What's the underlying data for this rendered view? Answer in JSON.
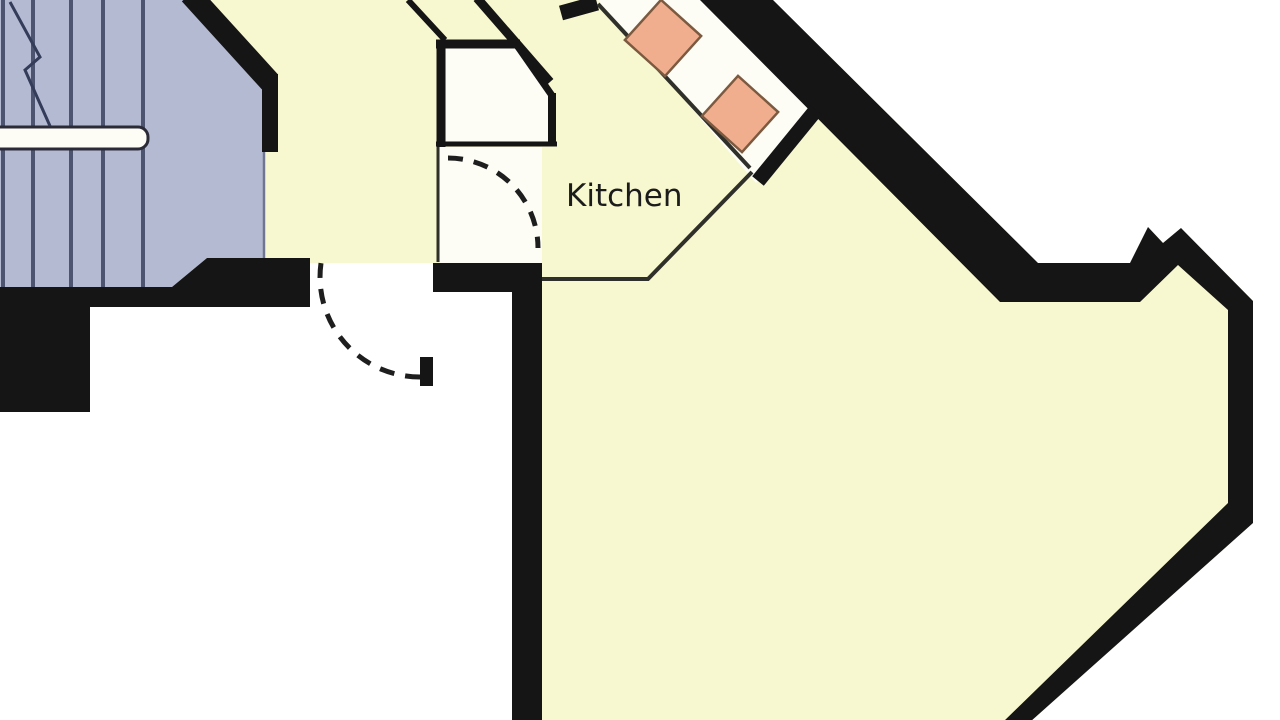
{
  "title": "Apartment floor plan",
  "labels": {
    "kitchen": "Kitchen"
  },
  "rooms": [
    "stairwell",
    "hallway",
    "closet",
    "vestibule",
    "kitchen",
    "living-area",
    "unfinished-room"
  ],
  "palette": {
    "paper": "#ffffff",
    "white": "#fdfdf6",
    "cream": "#f8f8d0",
    "blue": "#b5bad3",
    "tread": "#4c5470",
    "zigzag": "#333c58",
    "railStroke": "#2b2b38",
    "wall": "#151515",
    "thin": "#30302a",
    "arc": "#1e1e1e",
    "orange": "#f1ae8e",
    "orangeBorder": "#7b5a40",
    "text": "#1c1c1c",
    "edge": "#707690"
  },
  "floorplan": {
    "width": 1280,
    "height": 720,
    "elements": [
      {
        "name": "canvas-background",
        "type": "rect",
        "x": 0,
        "y": 0,
        "w": 1280,
        "h": 720,
        "fill": "paper"
      },
      {
        "name": "apartment-floor",
        "type": "polygon",
        "fill": "cream",
        "points": [
          [
            0,
            0
          ],
          [
            773,
            0
          ],
          [
            1038,
            263
          ],
          [
            1130,
            263
          ],
          [
            1148,
            227
          ],
          [
            1163,
            243
          ],
          [
            1181,
            228
          ],
          [
            1253,
            301
          ],
          [
            1253,
            523
          ],
          [
            1030,
            722
          ],
          [
            540,
            722
          ],
          [
            540,
            263
          ],
          [
            310,
            263
          ],
          [
            310,
            307
          ],
          [
            0,
            307
          ]
        ]
      },
      {
        "name": "closet-floor",
        "type": "polygon",
        "fill": "white",
        "points": [
          [
            446,
            47
          ],
          [
            516,
            47
          ],
          [
            549,
            97
          ],
          [
            549,
            141
          ],
          [
            446,
            141
          ]
        ]
      },
      {
        "name": "vestibule-floor",
        "type": "rect",
        "x": 440,
        "y": 147,
        "w": 102,
        "h": 116,
        "fill": "white"
      },
      {
        "name": "kitchen-counter",
        "type": "polygon",
        "fill": "white",
        "points": [
          [
            598,
            0
          ],
          [
            702,
            0
          ],
          [
            820,
            115
          ],
          [
            756,
            183
          ]
        ]
      },
      {
        "name": "stairwell-floor",
        "type": "polygon",
        "fill": "blue",
        "points": [
          [
            0,
            0
          ],
          [
            185,
            0
          ],
          [
            263,
            84
          ],
          [
            263,
            258
          ],
          [
            207,
            258
          ],
          [
            172,
            287
          ],
          [
            0,
            287
          ]
        ]
      },
      {
        "name": "stair-tread",
        "type": "vlines",
        "xs": [
          3,
          33,
          71,
          103,
          143
        ],
        "y1": 0,
        "y2": 287,
        "stroke": "tread",
        "w": 4
      },
      {
        "name": "stair-handrail",
        "type": "rect",
        "x": -12,
        "y": 127,
        "w": 160,
        "h": 22,
        "rx": 10,
        "fill": "white",
        "stroke": "railStroke",
        "sw": 3
      },
      {
        "name": "stair-break-line",
        "type": "polyline",
        "points": [
          [
            10,
            2
          ],
          [
            40,
            57
          ],
          [
            25,
            70
          ],
          [
            50,
            126
          ]
        ],
        "stroke": "zigzag",
        "w": 3
      },
      {
        "name": "stairwell-edge",
        "type": "line",
        "x1": 264,
        "y1": 88,
        "x2": 264,
        "y2": 260,
        "stroke": "edge",
        "w": 2.5
      },
      {
        "name": "wall-stair-northeast",
        "type": "line",
        "x1": 190,
        "y1": -6,
        "x2": 270,
        "y2": 82,
        "stroke": "wall",
        "w": 22
      },
      {
        "name": "wall-stair-east",
        "type": "line",
        "x1": 270,
        "y1": 74,
        "x2": 270,
        "y2": 152,
        "stroke": "wall",
        "w": 16
      },
      {
        "name": "wall-exterior-right",
        "type": "polygon",
        "fill": "wall",
        "points": [
          [
            700,
            0
          ],
          [
            773,
            0
          ],
          [
            1038,
            263
          ],
          [
            1130,
            263
          ],
          [
            1148,
            227
          ],
          [
            1163,
            243
          ],
          [
            1181,
            228
          ],
          [
            1253,
            301
          ],
          [
            1253,
            523
          ],
          [
            1030,
            722
          ],
          [
            1003,
            722
          ],
          [
            1228,
            503
          ],
          [
            1228,
            310
          ],
          [
            1178,
            265
          ],
          [
            1140,
            302
          ],
          [
            1000,
            302
          ]
        ]
      },
      {
        "name": "wall-hall-south",
        "type": "polygon",
        "fill": "wall",
        "points": [
          [
            0,
            287
          ],
          [
            172,
            287
          ],
          [
            207,
            258
          ],
          [
            310,
            258
          ],
          [
            310,
            307
          ],
          [
            0,
            307
          ]
        ]
      },
      {
        "name": "wall-hall-southwest",
        "type": "rect",
        "x": 0,
        "y": 287,
        "w": 90,
        "h": 125,
        "fill": "wall"
      },
      {
        "name": "wall-living-west",
        "type": "polygon",
        "fill": "wall",
        "points": [
          [
            433,
            263
          ],
          [
            542,
            263
          ],
          [
            542,
            722
          ],
          [
            512,
            722
          ],
          [
            512,
            292
          ],
          [
            433,
            292
          ]
        ]
      },
      {
        "name": "closet-wall-west",
        "type": "line",
        "x1": 441,
        "y1": 40,
        "x2": 441,
        "y2": 147,
        "stroke": "wall",
        "w": 9
      },
      {
        "name": "closet-wall-north",
        "type": "line",
        "x1": 436,
        "y1": 44,
        "x2": 520,
        "y2": 44,
        "stroke": "wall",
        "w": 9
      },
      {
        "name": "closet-wall-corner",
        "type": "line",
        "x1": 514,
        "y1": 41,
        "x2": 553,
        "y2": 97,
        "stroke": "wall",
        "w": 7
      },
      {
        "name": "closet-wall-east",
        "type": "line",
        "x1": 552,
        "y1": 93,
        "x2": 552,
        "y2": 146,
        "stroke": "wall",
        "w": 8
      },
      {
        "name": "closet-wall-south",
        "type": "line",
        "x1": 436,
        "y1": 144,
        "x2": 557,
        "y2": 144,
        "stroke": "wall",
        "w": 5
      },
      {
        "name": "vestibule-wall-west",
        "type": "line",
        "x1": 438,
        "y1": 147,
        "x2": 438,
        "y2": 262,
        "stroke": "thin",
        "w": 3
      },
      {
        "name": "wall-hall-kitchen",
        "type": "line",
        "x1": 477,
        "y1": -2,
        "x2": 550,
        "y2": 82,
        "stroke": "wall",
        "w": 9
      },
      {
        "name": "door-leaf-entrance",
        "type": "line",
        "x1": 408,
        "y1": 0,
        "x2": 445,
        "y2": 40,
        "stroke": "wall",
        "w": 6
      },
      {
        "name": "counter-end-north",
        "type": "line",
        "x1": 561,
        "y1": 13,
        "x2": 597,
        "y2": 3,
        "stroke": "wall",
        "w": 15
      },
      {
        "name": "counter-end-south",
        "type": "line",
        "x1": 816,
        "y1": 110,
        "x2": 758,
        "y2": 181,
        "stroke": "wall",
        "w": 15
      },
      {
        "name": "counter-front-edge",
        "type": "line",
        "x1": 598,
        "y1": 4,
        "x2": 750,
        "y2": 168,
        "stroke": "thin",
        "w": 4
      },
      {
        "name": "kitchen-boundary-line",
        "type": "polyline",
        "points": [
          [
            542,
            279
          ],
          [
            648,
            279
          ],
          [
            752,
            172
          ]
        ],
        "stroke": "thin",
        "w": 4
      },
      {
        "name": "door-swing-hall",
        "type": "arc",
        "cx": 420,
        "cy": 277,
        "r": 100,
        "a1": 90,
        "a2": 188,
        "stroke": "arc",
        "w": 5,
        "dash": "15 11"
      },
      {
        "name": "door-swing-vestibule",
        "type": "arc",
        "cx": 448,
        "cy": 248,
        "r": 90,
        "a1": -90,
        "a2": 0,
        "stroke": "arc",
        "w": 5,
        "dash": "15 11"
      },
      {
        "name": "door-jamb",
        "type": "rect",
        "x": 420,
        "y": 357,
        "w": 13,
        "h": 29,
        "fill": "wall"
      },
      {
        "name": "hob-unit-1",
        "type": "rect",
        "x": 636,
        "y": 11,
        "w": 54,
        "h": 54,
        "fill": "orange",
        "stroke": "orangeBorder",
        "sw": 2.5,
        "rotate": "42 663 38"
      },
      {
        "name": "hob-unit-2",
        "type": "rect",
        "x": 713,
        "y": 87,
        "w": 54,
        "h": 54,
        "fill": "orange",
        "stroke": "orangeBorder",
        "sw": 2.5,
        "rotate": "42 740 114"
      },
      {
        "name": "room-label-kitchen",
        "type": "text",
        "x": 566,
        "y": 206,
        "bind": "labels.kitchen",
        "fill": "text"
      }
    ]
  }
}
